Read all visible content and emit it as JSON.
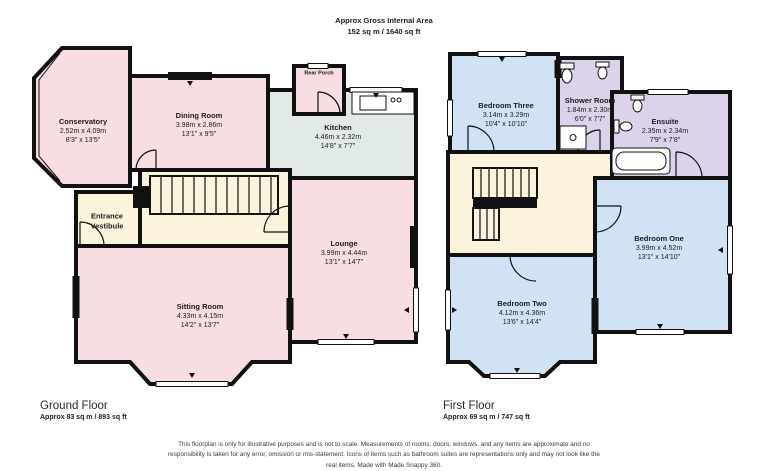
{
  "header": {
    "line1": "Approx Gross Internal Area",
    "line2": "152 sq m / 1640 sq ft"
  },
  "ground_floor": {
    "title": "Ground Floor",
    "area": "Approx 83 sq m / 893 sq ft",
    "rooms": {
      "conservatory": {
        "name": "Conservatory",
        "metric": "2.52m x 4.09m",
        "imperial": "8'3\" x 13'5\""
      },
      "dining_room": {
        "name": "Dining Room",
        "metric": "3.98m x 2.86m",
        "imperial": "13'1\" x 9'5\""
      },
      "kitchen": {
        "name": "Kitchen",
        "metric": "4.46m x 2.32m",
        "imperial": "14'8\" x 7'7\""
      },
      "rear_porch": {
        "name": "Rear Porch"
      },
      "entrance_vestibule": {
        "name": "Entrance Vestibule"
      },
      "lounge": {
        "name": "Lounge",
        "metric": "3.99m x 4.44m",
        "imperial": "13'1\" x 14'7\""
      },
      "sitting_room": {
        "name": "Sitting Room",
        "metric": "4.33m x 4.15m",
        "imperial": "14'2\" x 13'7\""
      }
    }
  },
  "first_floor": {
    "title": "First Floor",
    "area": "Approx 69 sq m / 747 sq ft",
    "rooms": {
      "bedroom_three": {
        "name": "Bedroom Three",
        "metric": "3.14m x 3.29m",
        "imperial": "10'4\" x 10'10\""
      },
      "shower_room": {
        "name": "Shower Room",
        "metric": "1.84m x 2.30m",
        "imperial": "6'0\" x 7'7\""
      },
      "ensuite": {
        "name": "Ensuite",
        "metric": "2.35m x 2.34m",
        "imperial": "7'9\" x 7'8\""
      },
      "bedroom_one": {
        "name": "Bedroom One",
        "metric": "3.99m x 4.52m",
        "imperial": "13'1\" x 14'10\""
      },
      "bedroom_two": {
        "name": "Bedroom Two",
        "metric": "4.12m x 4.36m",
        "imperial": "13'6\" x 14'4\""
      }
    }
  },
  "footer": {
    "disclaimer": "This floorplan is only for illustrative purposes and is not to scale. Measurements of rooms, doors, windows, and any items are approximate and no responsibility is taken for any error, omission or mis-statement. Icons of items such as bathroom suites are representations only and may not look like the real items. Made with Made Snappy 360."
  },
  "colors": {
    "wall": "#111111",
    "room_pink": "#f8dde2",
    "room_cream": "#fbf3dc",
    "room_mint": "#e1eae4",
    "room_blue": "#d0e2f4",
    "room_lavender": "#dcd2ea"
  }
}
